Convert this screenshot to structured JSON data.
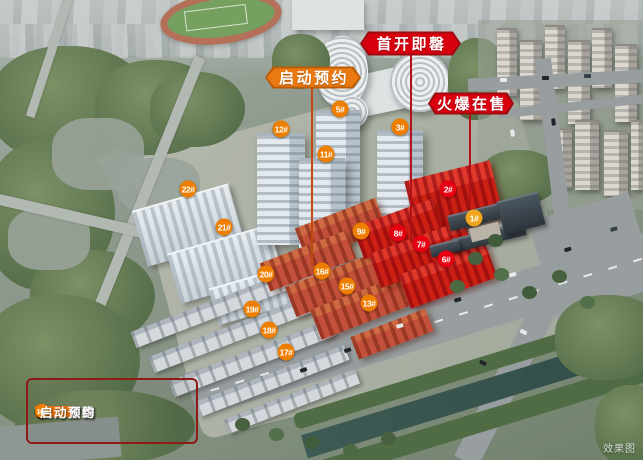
{
  "watermark": "效果图",
  "schemes": {
    "red": {
      "fill": "#d8000f",
      "border": "#9d0a0f",
      "line": "#b01218"
    },
    "orange": {
      "fill": "#e97910",
      "border": "#bc5c06",
      "line": "#c24a10"
    }
  },
  "callouts": [
    {
      "id": "qidong-yuyue",
      "label": "启动预约",
      "scheme": "orange",
      "x": 265,
      "y": 66,
      "w": 96,
      "h": 23,
      "line": {
        "x": 312,
        "y1": 88,
        "y2": 266
      }
    },
    {
      "id": "shoukai-jiqing",
      "label": "首开即罄",
      "scheme": "red",
      "x": 360,
      "y": 31,
      "w": 101,
      "h": 25,
      "line": {
        "x": 411,
        "y1": 55,
        "y2": 243
      }
    },
    {
      "id": "huobao-zaishou",
      "label": "火爆在售",
      "scheme": "red",
      "x": 428,
      "y": 92,
      "w": 86,
      "h": 23,
      "line": {
        "x": 470,
        "y1": 114,
        "y2": 204
      }
    }
  ],
  "badge_colors": {
    "orange": "#ee7e00",
    "red": "#e60012",
    "gold": "#f0a51e"
  },
  "badges": [
    {
      "label": "12#",
      "status": "orange",
      "x": 281,
      "y": 129
    },
    {
      "label": "5#",
      "status": "orange",
      "x": 340,
      "y": 109
    },
    {
      "label": "3#",
      "status": "orange",
      "x": 400,
      "y": 127
    },
    {
      "label": "11#",
      "status": "orange",
      "x": 326,
      "y": 154
    },
    {
      "label": "22#",
      "status": "orange",
      "x": 188,
      "y": 189
    },
    {
      "label": "21#",
      "status": "orange",
      "x": 224,
      "y": 227
    },
    {
      "label": "2#",
      "status": "red",
      "x": 448,
      "y": 189
    },
    {
      "label": "1#",
      "status": "gold",
      "x": 474,
      "y": 218
    },
    {
      "label": "9#",
      "status": "orange",
      "x": 361,
      "y": 231
    },
    {
      "label": "8#",
      "status": "red",
      "x": 398,
      "y": 233
    },
    {
      "label": "7#",
      "status": "red",
      "x": 421,
      "y": 244
    },
    {
      "label": "6#",
      "status": "red",
      "x": 446,
      "y": 259
    },
    {
      "label": "20#",
      "status": "orange",
      "x": 266,
      "y": 274
    },
    {
      "label": "16#",
      "status": "orange",
      "x": 322,
      "y": 271
    },
    {
      "label": "15#",
      "status": "orange",
      "x": 347,
      "y": 286
    },
    {
      "label": "13#",
      "status": "orange",
      "x": 369,
      "y": 303
    },
    {
      "label": "19#",
      "status": "orange",
      "x": 252,
      "y": 309
    },
    {
      "label": "18#",
      "status": "orange",
      "x": 269,
      "y": 330
    },
    {
      "label": "17#",
      "status": "orange",
      "x": 286,
      "y": 352
    }
  ],
  "legend": {
    "rows": [
      {
        "swatch": "#e60012",
        "badge_color": "#e60012",
        "badges": [
          "2#"
        ],
        "label": "火爆在售"
      },
      {
        "swatch": "#d7000f",
        "badge_color": "#e60012",
        "badges": [
          "6#",
          "7#",
          "8#"
        ],
        "label": "首开即罄"
      },
      {
        "swatch": "#e87511",
        "badge_color": "#ee7e00",
        "badges": [
          "9#",
          "13#",
          "15#",
          "16#"
        ],
        "label": "启动预约"
      }
    ]
  }
}
